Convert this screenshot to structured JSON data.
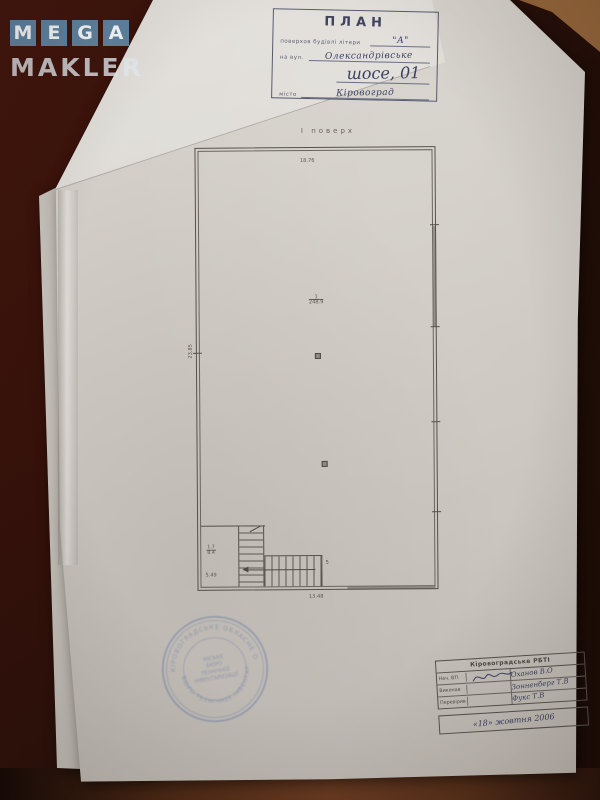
{
  "watermark": {
    "letters": [
      "M",
      "E",
      "G",
      "A"
    ],
    "word_bottom": "MAKLER",
    "tile_color": "#68a3cb"
  },
  "title_block": {
    "title": "ПЛАН",
    "subtitle_label": "поверхов будівлі літери",
    "building_letter": "\"А\"",
    "street_label": "на вул.",
    "street_value": "Олександрівське",
    "street_value2": "шосе, 01",
    "city_label": "місто",
    "city_value": "Кіровоград"
  },
  "plan": {
    "floor_label": "І поверх",
    "dim_top": "18.76",
    "dim_left": "23.85",
    "dim_bottom": "13.48",
    "room_number": "1",
    "room_area": "248.9",
    "stair_frac_top": "1.7",
    "stair_frac_bottom": "8.4",
    "stair_width": "5.49",
    "stair_count": "5",
    "line_color": "#55514b"
  },
  "stamp": {
    "ring_top": "КІРОВОГРАДСЬКЕ ОБЛАСНЕ ОБ'ЄДНАНЕ",
    "ring_bottom": "БЮРО ТЕХНІЧНОЇ ІНВЕНТАРИЗАЦІЇ",
    "center_lines": [
      "МІСЬКЕ",
      "БЮРО",
      "ТЕХНІЧНОЇ",
      "ІНВЕНТАРИЗАЦІЇ"
    ],
    "color": "#5f74a8"
  },
  "footer": {
    "header": "Кіровоградське РБТІ",
    "rows": [
      {
        "label": "Нач. ВТІ",
        "name": "Оханов В.О"
      },
      {
        "label": "Виконав",
        "name": "Зонненберг Т.В"
      },
      {
        "label": "Перевірив",
        "name": "Фукс Т.В"
      }
    ],
    "date_line": "«18» жовтня 2006"
  }
}
